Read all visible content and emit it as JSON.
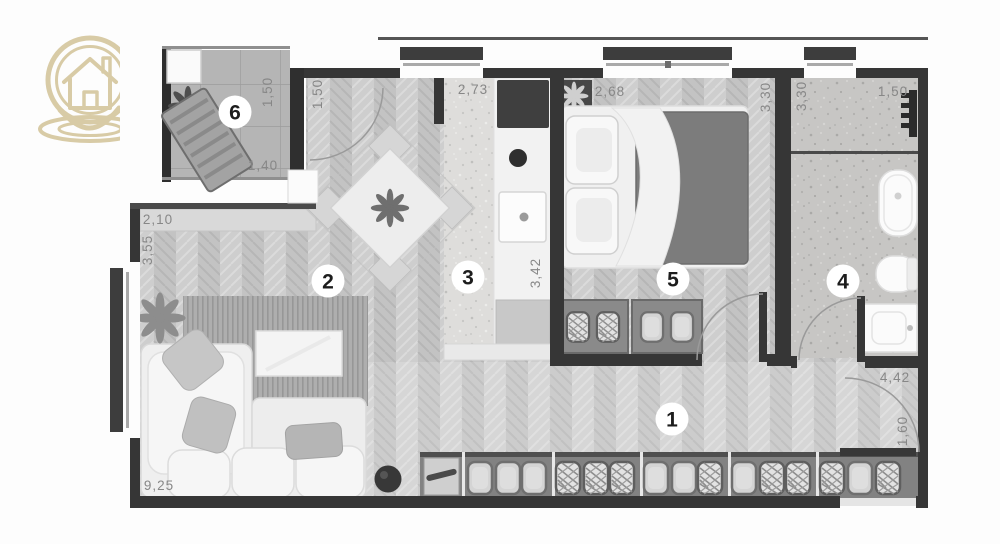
{
  "plan": {
    "badges": {
      "hallway": "1",
      "living_room": "2",
      "kitchen": "3",
      "bathroom": "4",
      "bedroom": "5",
      "balcony": "6"
    },
    "dimensions": {
      "living_top_width": "2,10",
      "living_left_height": "3,55",
      "living_bottom_length": "9,25",
      "balcony_depth": "1,50",
      "balcony_width": "1,40",
      "balcony_door_width": "1,50",
      "kitchen_top_width": "2,73",
      "kitchen_side_depth": "3,42",
      "bedroom_top_width": "2,68",
      "bedroom_side_depth": "3,30",
      "bathroom_side_depth": "3,30",
      "bathroom_top_width": "1,50",
      "hallway_top_width": "4,42",
      "entrance_door_width": "1,60"
    },
    "colors": {
      "wall": "#363636",
      "logo_accent": "#d8cba6",
      "duvet": "#7c7c7c",
      "floor_wood": "#c9c9c9"
    }
  }
}
